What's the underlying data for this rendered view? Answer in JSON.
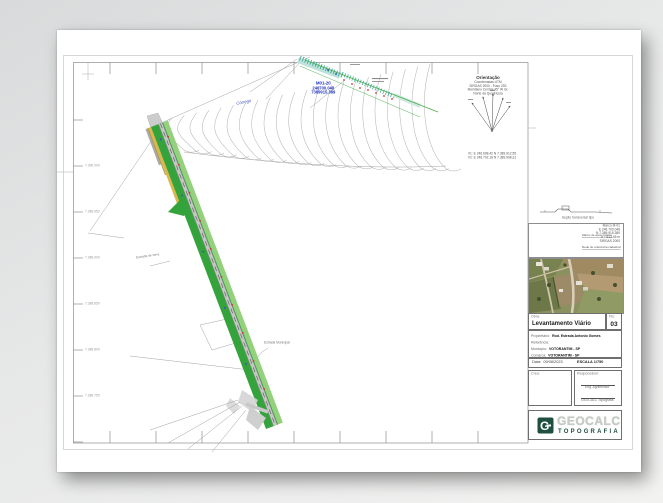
{
  "compass": {
    "title": "Orientação",
    "lines": [
      "Coordenadas UTM",
      "SIRGAS 2000 - Fuso 23S",
      "Meridiano Central 45° W Gr.",
      "Norte da Quadrícula"
    ],
    "footer_lines": [
      "V1: E 246.698,42  N 7.389.912,55",
      "V2: E 246.702,18  N 7.389.908,31"
    ]
  },
  "survey_label": {
    "line1": "M01-20",
    "line2": "246700.048",
    "line3": "7389915.389",
    "color": "#2233bb"
  },
  "map_labels": {
    "stream": "Córrego",
    "road_left": "Estrada de terra",
    "road_bottom": "Estrada Municipal"
  },
  "section": {
    "caption": "Seção transversal tipo"
  },
  "sketch": {
    "lines": [
      "Marco M-01",
      "E 246.700,048",
      "N 7.389.915,389",
      "h = 612,45 m",
      "SIRGAS 2000"
    ],
    "ann1": "Marco de apoio básico",
    "ann2": "Rede de referência cadastral"
  },
  "grid": {
    "left_labels": [
      "7.390.000",
      "7.389.950",
      "7.389.900",
      "7.389.850",
      "7.389.800",
      "7.389.750"
    ]
  },
  "titleblock": {
    "obra_label": "Obra:",
    "obra_value": "Levantamento Viário",
    "fls_label": "Fls:",
    "fls_value": "03",
    "rows": [
      {
        "label": "Proprietário:",
        "value": "Rod. Estrada Antonio Gomes"
      },
      {
        "label": "Referência:",
        "value": ""
      },
      {
        "label": "Município:",
        "value": "VOTORANTIM - SP"
      },
      {
        "label": "Comarca:",
        "value": "VOTORANTIM - SP"
      }
    ],
    "date_label": "Data:",
    "date_value": "09/08/2023",
    "scale_value": "ESCALA 1/750",
    "crea_label": "Crea:",
    "resp_label": "Responsável:",
    "resp_sig1": "Eng. Agrimensor",
    "resp_sig2": "GEOCALC Topografia",
    "logo_text": "GEOCALC",
    "logo_sub": "TOPOGRAFIA",
    "logo_color": "#1e4f41",
    "logo_text_color": "#c6cdc7"
  }
}
